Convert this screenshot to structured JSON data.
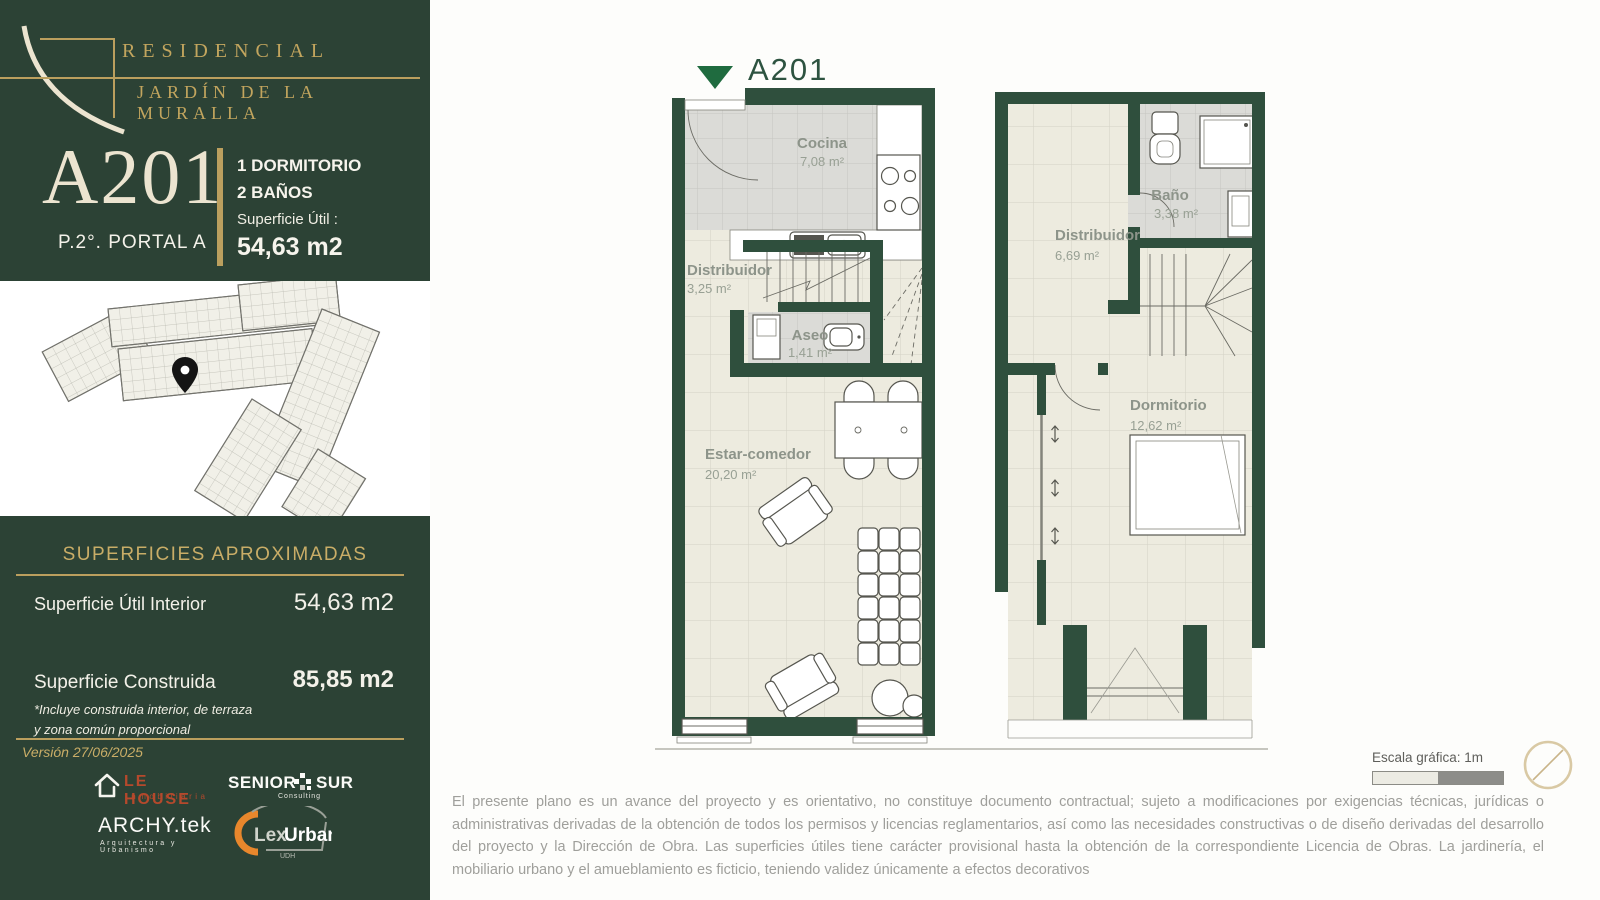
{
  "header": {
    "brand_line1": "RESIDENCIAL",
    "brand_line2": "JARDÍN DE LA MURALLA",
    "unit": "A201",
    "floor": "P.2°. PORTAL A",
    "feature1": "1 DORMITORIO",
    "feature2": "2 BAÑOS",
    "area_label": "Superficie  Útil :",
    "area_value": "54,63 m2"
  },
  "surfaces": {
    "title": "SUPERFICIES APROXIMADAS",
    "rows": [
      {
        "label": "Superficie  Útil Interior",
        "value": "54,63 m2"
      },
      {
        "label": "Superficie  Construida",
        "value": "85,85 m2"
      }
    ],
    "footnote_line1": "*Incluye construida interior, de terraza",
    "footnote_line2": "y zona común proporcional",
    "version": "Versión 27/06/2025"
  },
  "partners": {
    "lehouse_name": "LE HOUSE",
    "lehouse_sub": "inmobiliaria",
    "senior_left": "SENIOR",
    "senior_right": "SUR",
    "senior_sub": "Consulting",
    "archy_name": "ARCHY.tek",
    "archy_sub": "Arquitectura y Urbanismo",
    "lex_a": "Lex",
    "lex_b": "Urban",
    "lex_sub": "UDH"
  },
  "plans": {
    "marker_label": "A201",
    "floor1": {
      "cocina_name": "Cocina",
      "cocina_area": "7,08 m²",
      "dist_name": "Distribuidor",
      "dist_area": "3,25 m²",
      "aseo_name": "Aseo",
      "aseo_area": "1,41 m²",
      "estar_name": "Estar-comedor",
      "estar_area": "20,20 m²"
    },
    "floor2": {
      "bano_name": "Baño",
      "bano_area": "3,38 m²",
      "dist_name": "Distribuidor",
      "dist_area": "6,69 m²",
      "dorm_name": "Dormitorio",
      "dorm_area": "12,62 m²"
    }
  },
  "scale": {
    "label": "Escala gráfica:  1m"
  },
  "disclaimer": "El presente plano es un avance del proyecto y es orientativo, no constituye documento contractual; sujeto a modificaciones por exigencias técnicas, jurídicas o administrativas derivadas de la obtención de todos los permisos y licencias reglamentarios, así como las necesidades constructivas o de diseño derivadas del desarrollo del proyecto y la Dirección de Obra. Las superficies útiles tiene carácter provisional hasta la obtención de la correspondiente Licencia de Obras. La jardinería, el mobiliario urbano y el amueblamiento es ficticio, teniendo validez únicamente a efectos decorativos",
  "colors": {
    "panel_green": "#2c4235",
    "wall_green": "#2f4f3d",
    "gold": "#bb9f5e",
    "cream": "#ece4d0",
    "entry_green": "#1f6b3f",
    "floor_beige": "#edebdf",
    "floor_gray": "#dbdbd7"
  },
  "icons": {
    "location_pin": "map-pin",
    "entrance_marker": "triangle-down",
    "compass": "circle-with-needle"
  }
}
